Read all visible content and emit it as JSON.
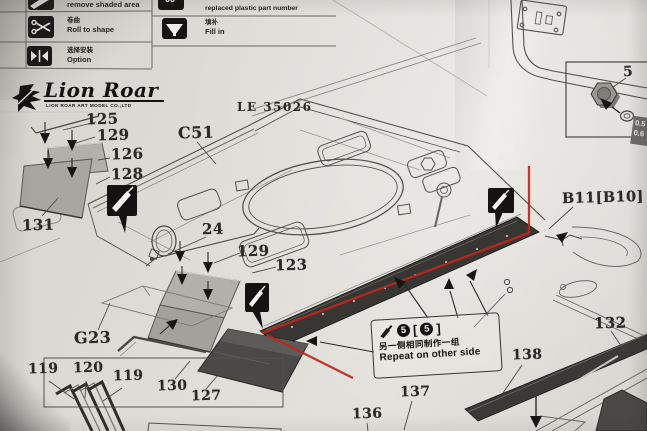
{
  "colors": {
    "red_highlight": "#c2251c",
    "icon_black": "#141312",
    "paper": "#dfddd8"
  },
  "brand": {
    "name": "Lion Roar",
    "subtitle": "LION ROAR ART MODEL CO.,LTD",
    "sheet_code": "LE 35026"
  },
  "legend": {
    "left": [
      {
        "icon": "shaded-area-icon",
        "zh": "",
        "en": "remove shaded area"
      },
      {
        "icon": "scissors-icon",
        "zh": "卷曲",
        "en": "Roll to shape"
      },
      {
        "icon": "option-arrows-icon",
        "zh": "选择安装",
        "en": "Option"
      }
    ],
    "right": [
      {
        "icon": "replaced-number-icon",
        "zh": "",
        "en": "replaced plastic part number",
        "glyph": "66"
      },
      {
        "icon": "fill-in-icon",
        "zh": "填补",
        "en": "Fill in"
      }
    ]
  },
  "note": {
    "icon": "glue-icon",
    "qty": "5",
    "bracket_open": "[",
    "bracket_close": "]",
    "zh": "另一侧相同制作一组",
    "en": "Repeat on other side"
  },
  "inset": {
    "part": "5",
    "size1": "0.5",
    "size2": "0.6"
  },
  "labels": {
    "l125": "125",
    "l129a": "129",
    "l126": "126",
    "l128": "128",
    "l131": "131",
    "c51": "C51",
    "l24": "24",
    "l129b": "129",
    "l123": "123",
    "g23": "G23",
    "l119a": "119",
    "l120": "120",
    "l119b": "119",
    "l130": "130",
    "l127": "127",
    "l136": "136",
    "l137": "137",
    "l138": "138",
    "l132": "132",
    "b11": "B11[B10]",
    "part5": "5"
  }
}
